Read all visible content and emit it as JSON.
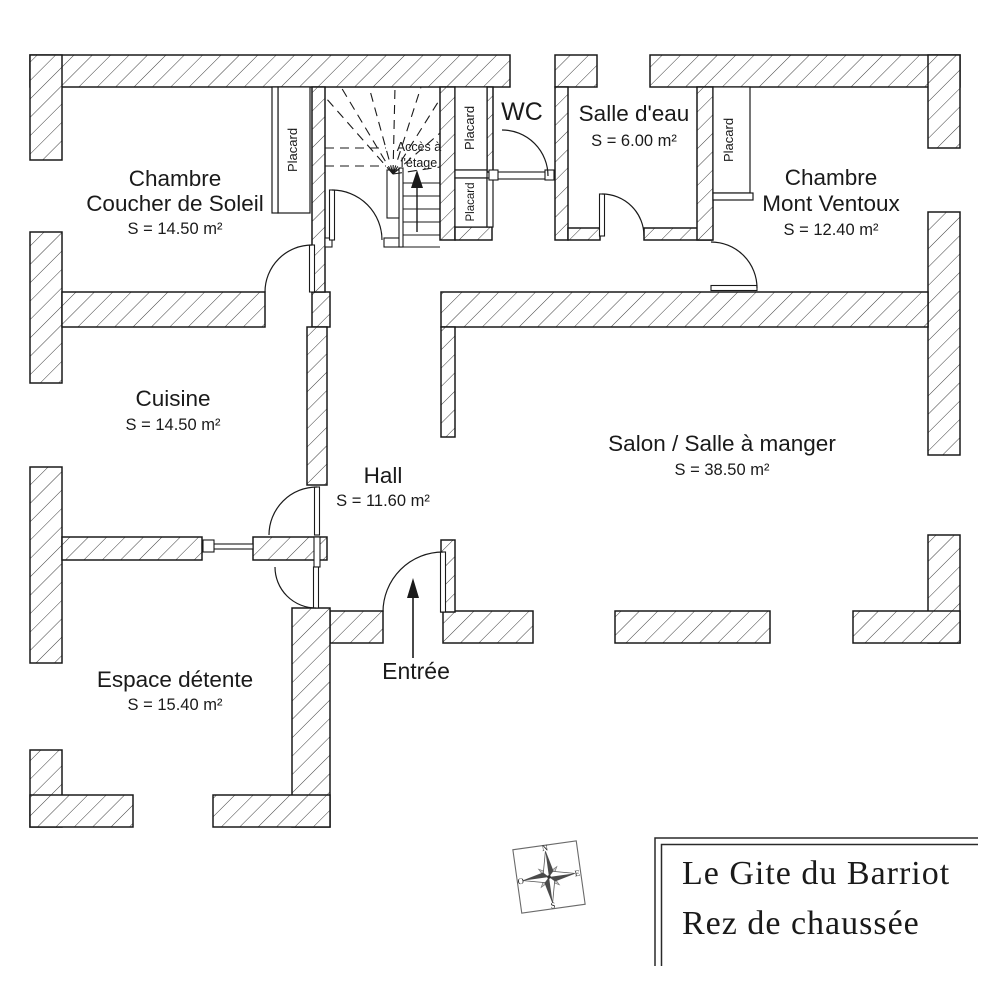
{
  "title_block": {
    "line1": "Le Gite du Barriot",
    "line2": "Rez de chaussée"
  },
  "compass": {
    "north": "N",
    "east": "E",
    "south": "S",
    "west": "O"
  },
  "labels": {
    "placard": "Placard",
    "access_line1": "Accès à",
    "access_line2": "l'étage",
    "entrance": "Entrée"
  },
  "rooms": [
    {
      "id": "chambre-coucher-de-soleil",
      "name_lines": [
        "Chambre",
        "Coucher de Soleil"
      ],
      "area": "S = 14.50 m²"
    },
    {
      "id": "salle-d-eau",
      "name_lines": [
        "Salle d'eau"
      ],
      "area": "S = 6.00 m²"
    },
    {
      "id": "wc",
      "name_lines": [
        "WC"
      ],
      "area": ""
    },
    {
      "id": "chambre-mont-ventoux",
      "name_lines": [
        "Chambre",
        "Mont Ventoux"
      ],
      "area": "S = 12.40 m²"
    },
    {
      "id": "cuisine",
      "name_lines": [
        "Cuisine"
      ],
      "area": "S = 14.50 m²"
    },
    {
      "id": "hall",
      "name_lines": [
        "Hall"
      ],
      "area": "S = 11.60 m²"
    },
    {
      "id": "salon",
      "name_lines": [
        "Salon / Salle à manger"
      ],
      "area": "S = 38.50 m²"
    },
    {
      "id": "espace-detente",
      "name_lines": [
        "Espace détente"
      ],
      "area": "S = 15.40 m²"
    }
  ]
}
